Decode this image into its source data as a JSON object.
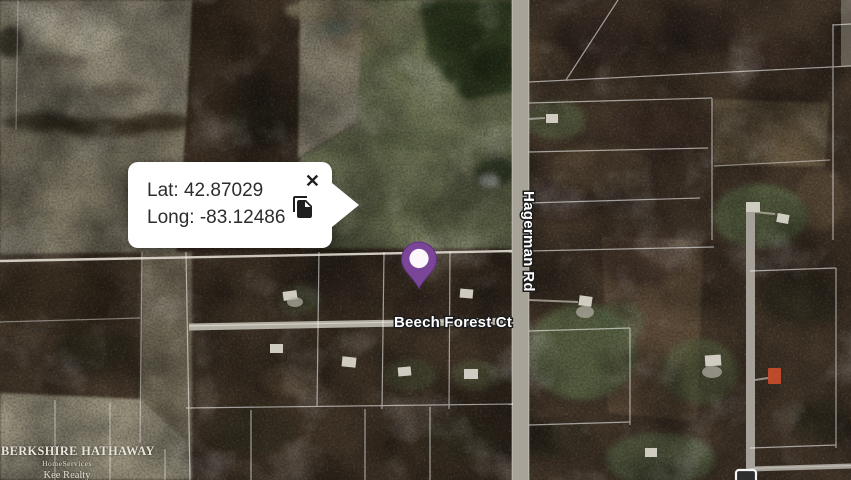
{
  "tooltip": {
    "lat": "Lat: 42.87029",
    "long": "Long: -83.12486",
    "close_glyph": "✕"
  },
  "map": {
    "labels": {
      "vertical_road": "Hagerman Rd",
      "horizontal_road": "Beech Forest Ct"
    },
    "marker": {
      "color": "#7B4598",
      "inner_color": "#FBF7FB"
    }
  },
  "watermark": {
    "brand": "BERKSHIRE HATHAWAY",
    "division": "HomeServices",
    "agency": "Kee Realty"
  },
  "colors": {
    "forest": "#46392B",
    "field_gray": "#8E8775",
    "field_green": "#6F7455",
    "road": "#A7A399",
    "parcel_line": "#FFFFFF",
    "accent_purple": "#7B4598",
    "house_red": "#BE4A2C"
  }
}
